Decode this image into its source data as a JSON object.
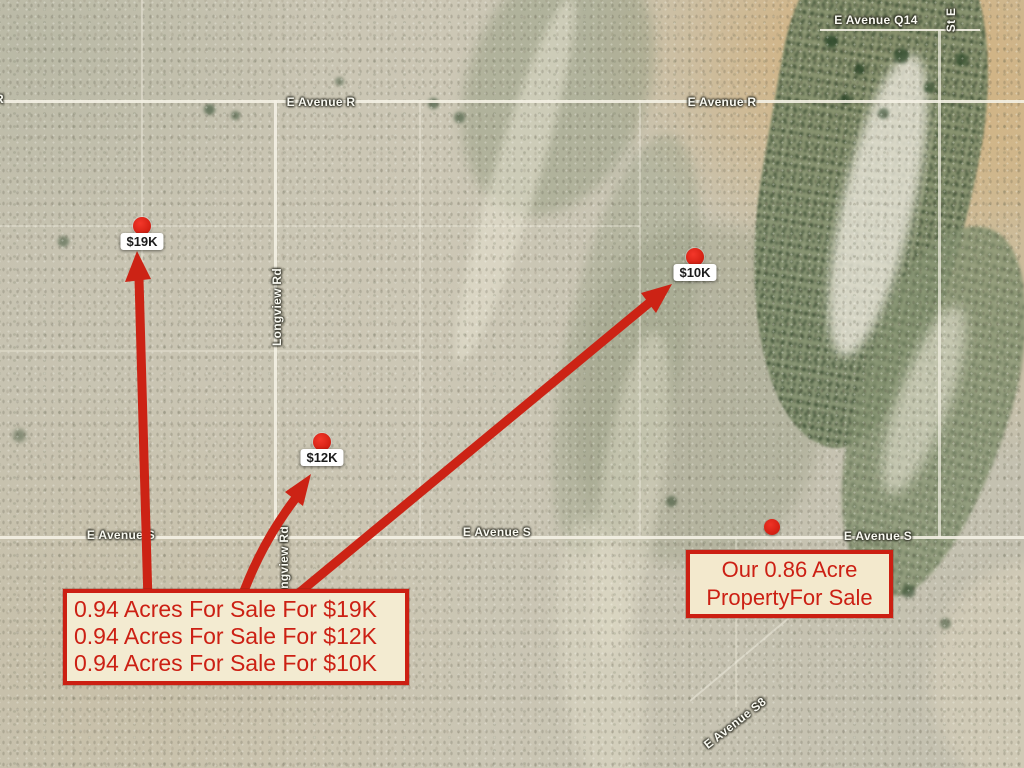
{
  "colors": {
    "annotation_red": "#cc1f12",
    "note_background": "#f3ebd1",
    "marker_dot_red": "#d21f12",
    "street_label_text": "#fafaf2"
  },
  "listing_box": {
    "lines": [
      "0.94 Acres For Sale For $19K",
      "0.94 Acres For Sale For $12K",
      "0.94 Acres For Sale For $10K"
    ]
  },
  "property_box": {
    "lines": [
      "Our 0.86 Acre",
      "PropertyFor Sale"
    ]
  },
  "price_markers": [
    {
      "label": "$19K"
    },
    {
      "label": "$12K"
    },
    {
      "label": "$10K"
    }
  ],
  "street_labels": {
    "avenue_q14": "E Avenue Q14",
    "avenue_r_west": "E Avenue R",
    "avenue_r_east": "E Avenue R",
    "avenue_s_west": "E Avenue S",
    "avenue_s_center": "E Avenue S",
    "avenue_s_east": "E Avenue S",
    "longview_rd_upper": "Longview Rd",
    "longview_rd_lower": "Longview Rd",
    "avenue_s8": "E Avenue S8",
    "st_e_edge": "St E",
    "west_edge_partial": "R"
  }
}
